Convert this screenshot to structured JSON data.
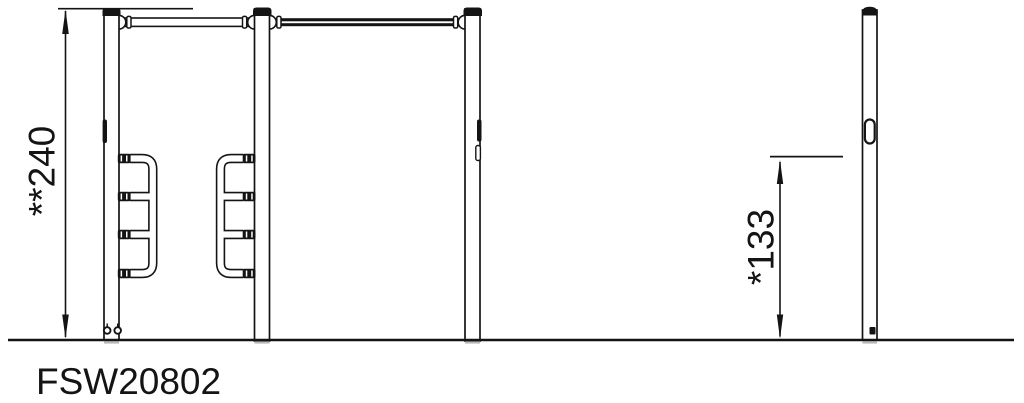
{
  "drawing": {
    "product_code": "FSW20802",
    "dimensions": {
      "total_height_label": "**240",
      "bar_height_label": "*133"
    }
  },
  "colors": {
    "line": "#141414",
    "background": "#ffffff",
    "shadow": "#b9b9b9"
  }
}
